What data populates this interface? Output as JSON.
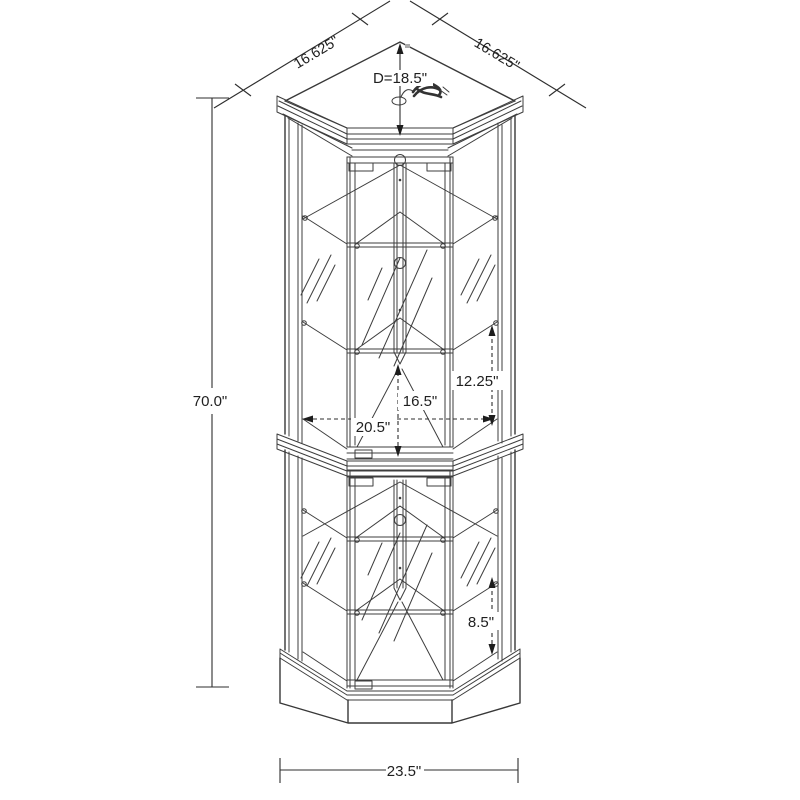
{
  "diagram": {
    "subject": "Corner curio display cabinet - dimension line drawing",
    "background_color": "#ffffff",
    "line_color": "#3d3d3d",
    "text_color": "#1f1f1f",
    "labels": {
      "top_left_width": "16.625\"",
      "top_right_width": "16.625\"",
      "depth": "D=18.5\"",
      "overall_height": "70.0\"",
      "upper_shelf_spacing": "12.25\"",
      "interior_depth": "16.5\"",
      "interior_width": "20.5\"",
      "lower_shelf_spacing": "8.5\"",
      "base_width": "23.5\""
    }
  }
}
